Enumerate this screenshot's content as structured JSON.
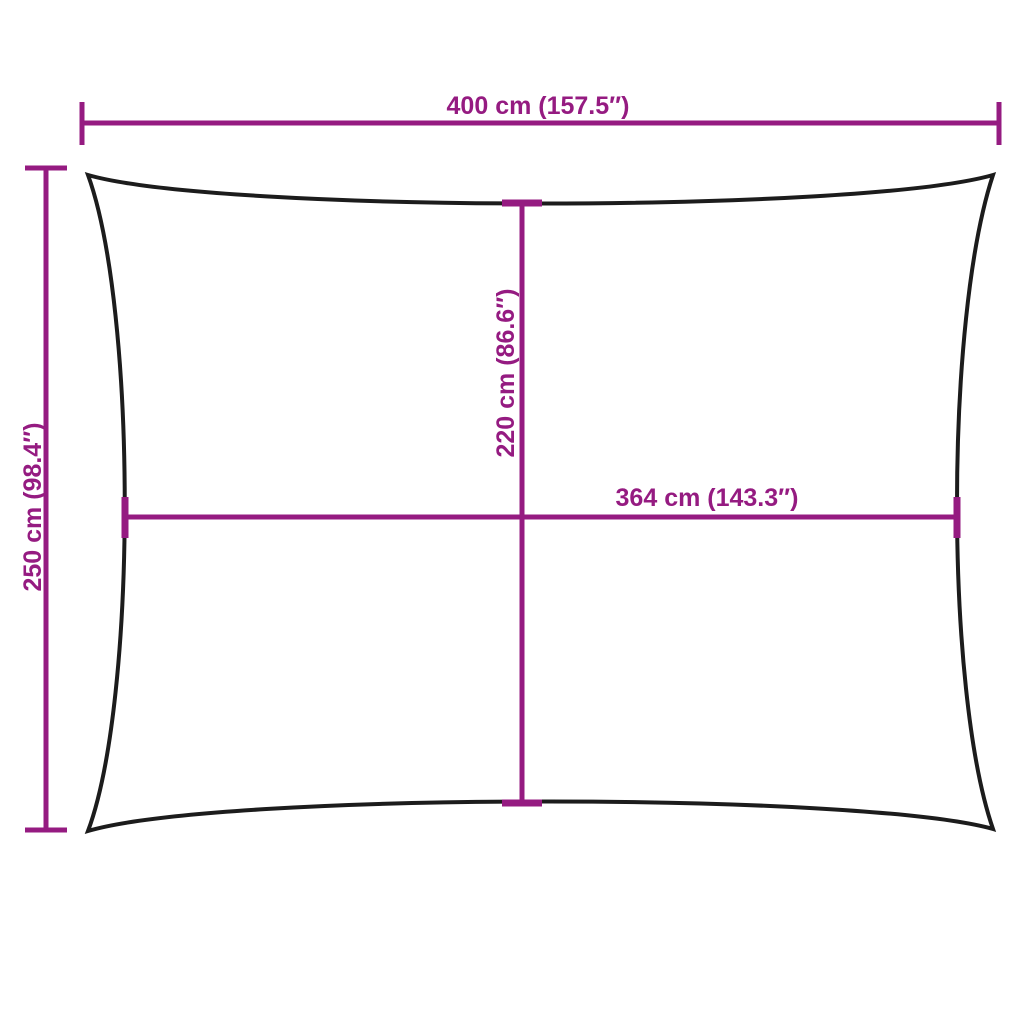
{
  "diagram": {
    "title": "shade-sail-dimension-diagram",
    "colors": {
      "dimension": "#951b81",
      "outline": "#1c1c1c",
      "background": "#ffffff"
    },
    "dimensions": {
      "overall_width": {
        "label": "400 cm (157.5″)",
        "value_cm": 400,
        "value_in": 157.5
      },
      "overall_height": {
        "label": "250 cm (98.4″)",
        "value_cm": 250,
        "value_in": 98.4
      },
      "inner_height": {
        "label": "220 cm (86.6″)",
        "value_cm": 220,
        "value_in": 86.6
      },
      "inner_width": {
        "label": "364 cm (143.3″)",
        "value_cm": 364,
        "value_in": 143.3
      }
    }
  }
}
